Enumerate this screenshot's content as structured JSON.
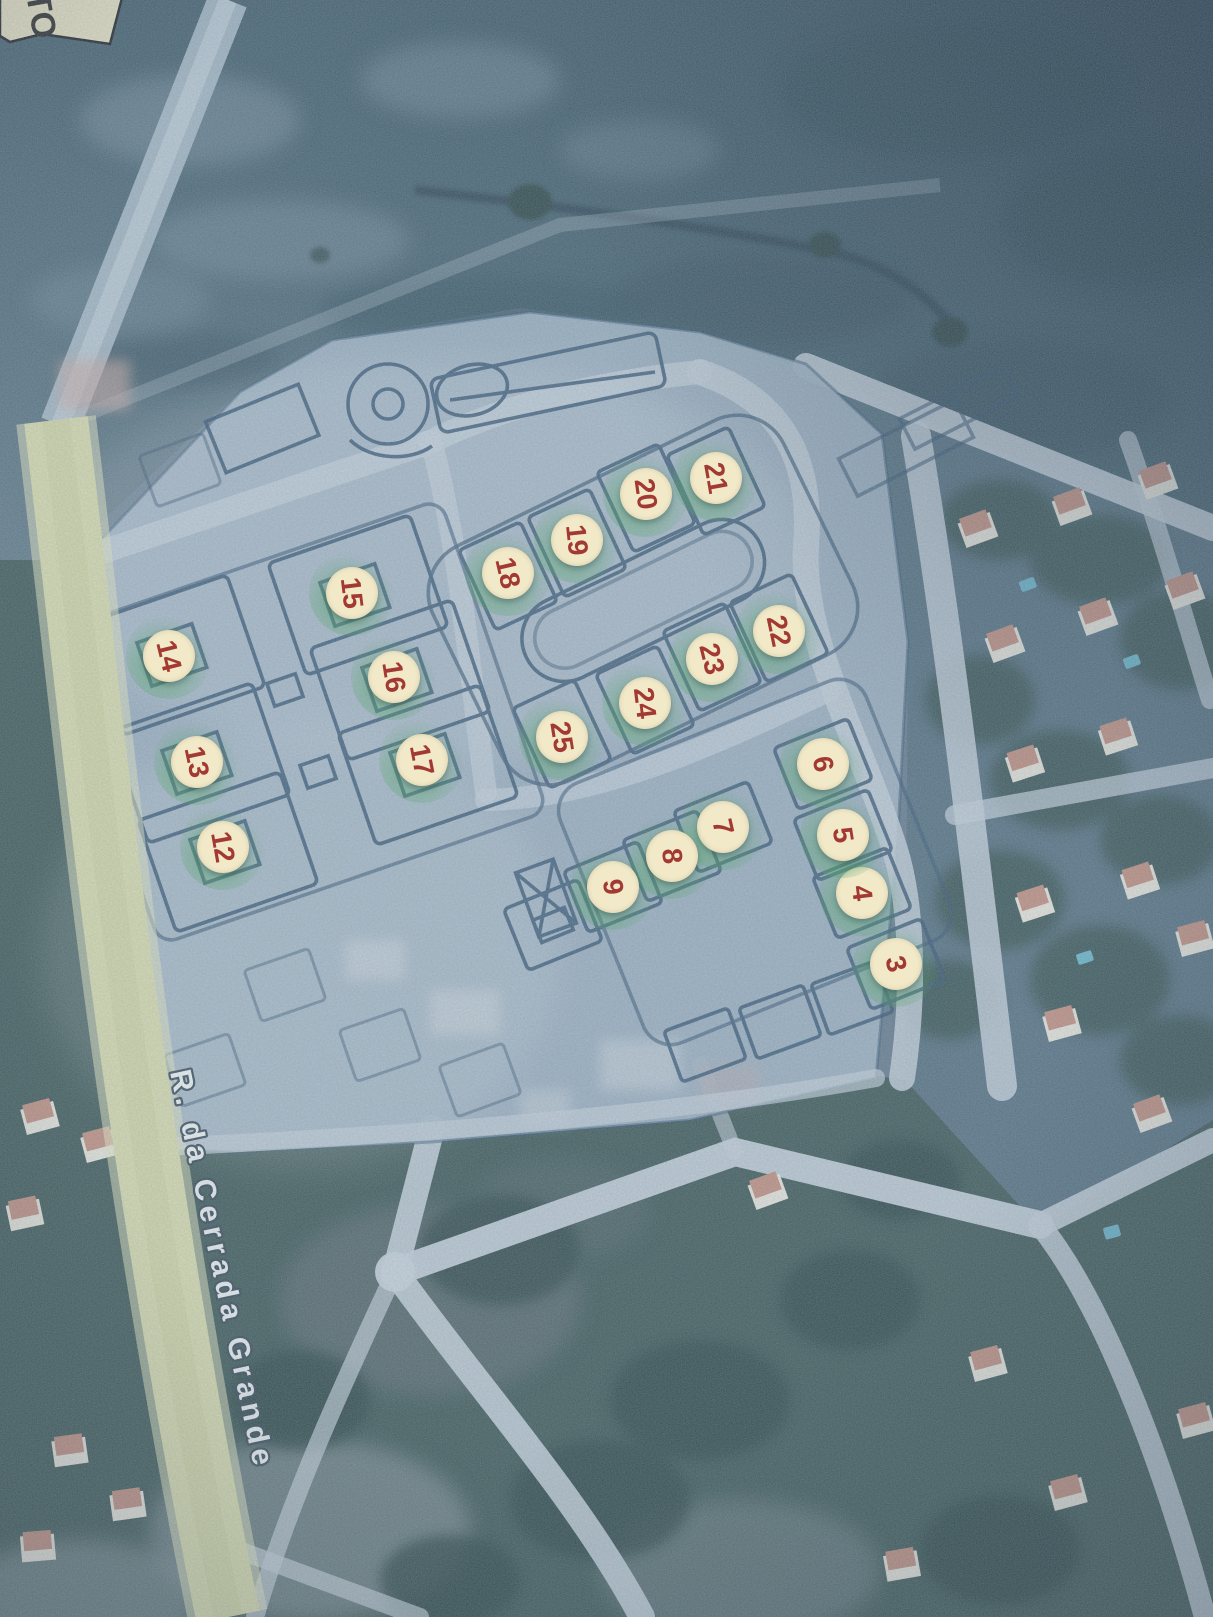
{
  "image_type": "photograph of a printed aerial map with a lot-allotment site plan overlay",
  "corner_label": {
    "text": "TO"
  },
  "street_label": {
    "text": "R. da Cerrada Grande"
  },
  "markers": [
    {
      "label": "3",
      "x": 896,
      "y": 964
    },
    {
      "label": "4",
      "x": 862,
      "y": 893
    },
    {
      "label": "5",
      "x": 843,
      "y": 835
    },
    {
      "label": "6",
      "x": 823,
      "y": 764
    },
    {
      "label": "7",
      "x": 723,
      "y": 827
    },
    {
      "label": "8",
      "x": 672,
      "y": 856
    },
    {
      "label": "9",
      "x": 613,
      "y": 887
    },
    {
      "label": "12",
      "x": 223,
      "y": 847
    },
    {
      "label": "13",
      "x": 197,
      "y": 762
    },
    {
      "label": "14",
      "x": 169,
      "y": 656
    },
    {
      "label": "15",
      "x": 352,
      "y": 593
    },
    {
      "label": "16",
      "x": 394,
      "y": 677
    },
    {
      "label": "17",
      "x": 422,
      "y": 760
    },
    {
      "label": "18",
      "x": 508,
      "y": 573
    },
    {
      "label": "19",
      "x": 577,
      "y": 540
    },
    {
      "label": "20",
      "x": 646,
      "y": 494
    },
    {
      "label": "21",
      "x": 716,
      "y": 478
    },
    {
      "label": "22",
      "x": 779,
      "y": 631
    },
    {
      "label": "23",
      "x": 712,
      "y": 659
    },
    {
      "label": "24",
      "x": 645,
      "y": 703
    },
    {
      "label": "25",
      "x": 562,
      "y": 737
    }
  ],
  "colors": {
    "marker_bg": "#f2e9c9",
    "marker_red": "#a23a33",
    "marker_glow": "#58a86d",
    "road_yellow": "#d7daa9",
    "plan_paper": "#9db1c2",
    "plan_line": "#2e4f6d",
    "road_light": "#c3cfd9",
    "roof": "#c08a7a",
    "pool": "#62b2c8",
    "street_text": "#f5f8f7",
    "street_outline": "#2e4050",
    "label_bg": "#ede5c3",
    "label_text": "#20201e"
  }
}
